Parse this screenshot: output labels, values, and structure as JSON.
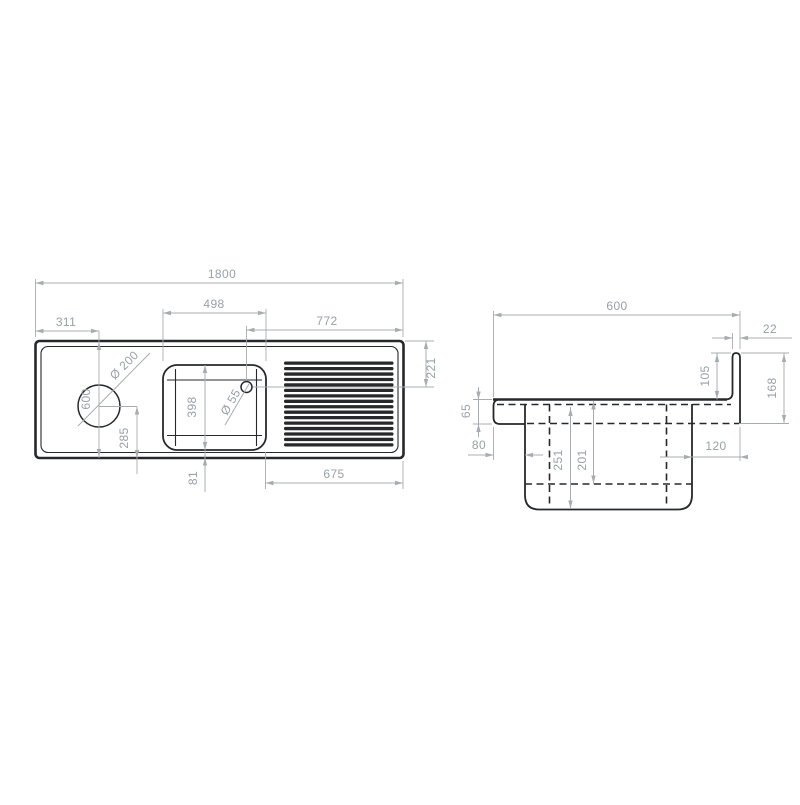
{
  "colors": {
    "background": "#ffffff",
    "drawing_line": "#26282b",
    "dimension_line": "#a8acb0",
    "dimension_text": "#98a0a8"
  },
  "plan_view": {
    "label": "plan-view-of-sink-unit",
    "dims": {
      "overall_length": "1800",
      "tap_center_from_left": "311",
      "bowl_length": "498",
      "waste_to_right_edge": "772",
      "waste_from_back_edge": "221",
      "overall_depth": "600",
      "tap_hole_diameter": "Ø 200",
      "waste_hole_diameter": "Ø 55",
      "bowl_width": "398",
      "tap_center_from_front": "285",
      "bowl_to_front_edge": "81",
      "drainer_length": "675"
    }
  },
  "section_view": {
    "label": "side-section-view-of-sink-unit",
    "dims": {
      "overall_depth": "600",
      "upstand_thickness": "22",
      "upstand_height": "105",
      "back_overall_height": "168",
      "front_edge_height": "65",
      "front_to_bowl": "80",
      "bowl_depth_outer": "251",
      "bowl_depth_inner": "201",
      "bowl_to_back": "120"
    }
  }
}
